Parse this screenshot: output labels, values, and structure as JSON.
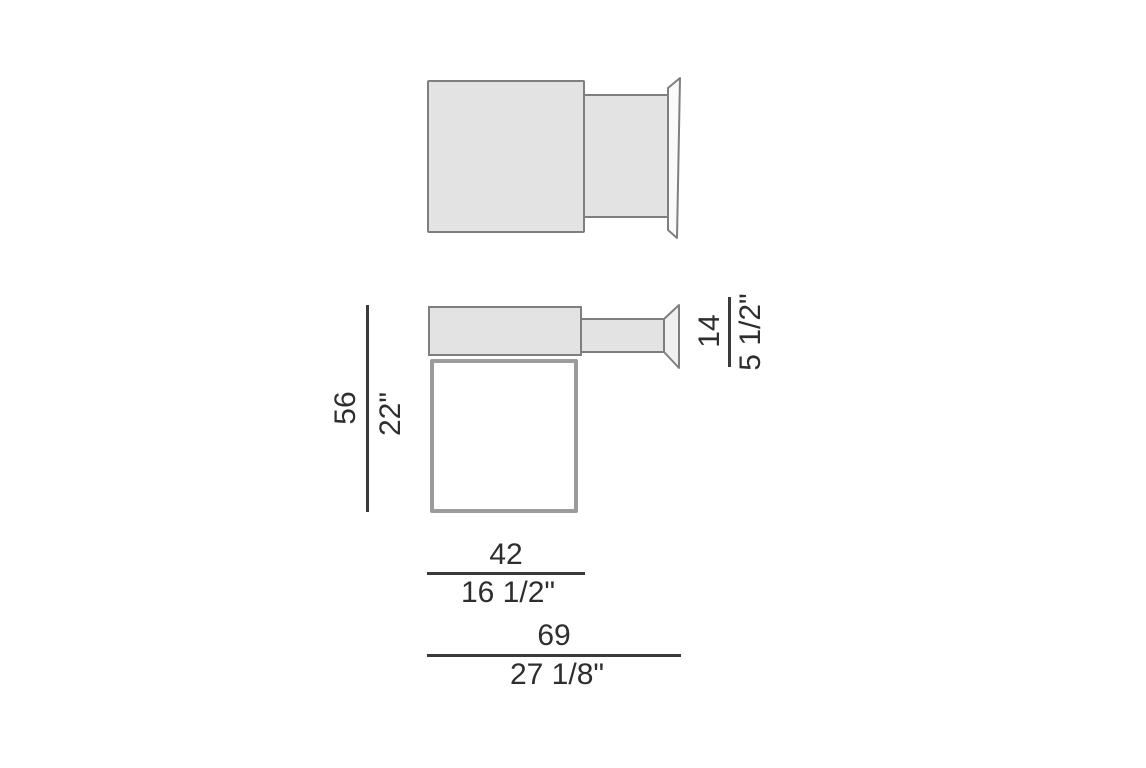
{
  "dimensions": {
    "height": {
      "cm": "56",
      "inch": "22\""
    },
    "clamp_arm": {
      "cm": "14",
      "inch": "5 1/2\""
    },
    "tabletop_width": {
      "cm": "42",
      "inch": "16 1/2\""
    },
    "overall_width": {
      "cm": "69",
      "inch": "27 1/8\""
    }
  },
  "colors": {
    "background": "#ffffff",
    "surface_fill": "#e3e3e3",
    "outline": "#7f7f7f",
    "frame_outline": "#9c9c9c",
    "dimension_line": "#3a3a3a",
    "text": "#2e2e2e"
  }
}
